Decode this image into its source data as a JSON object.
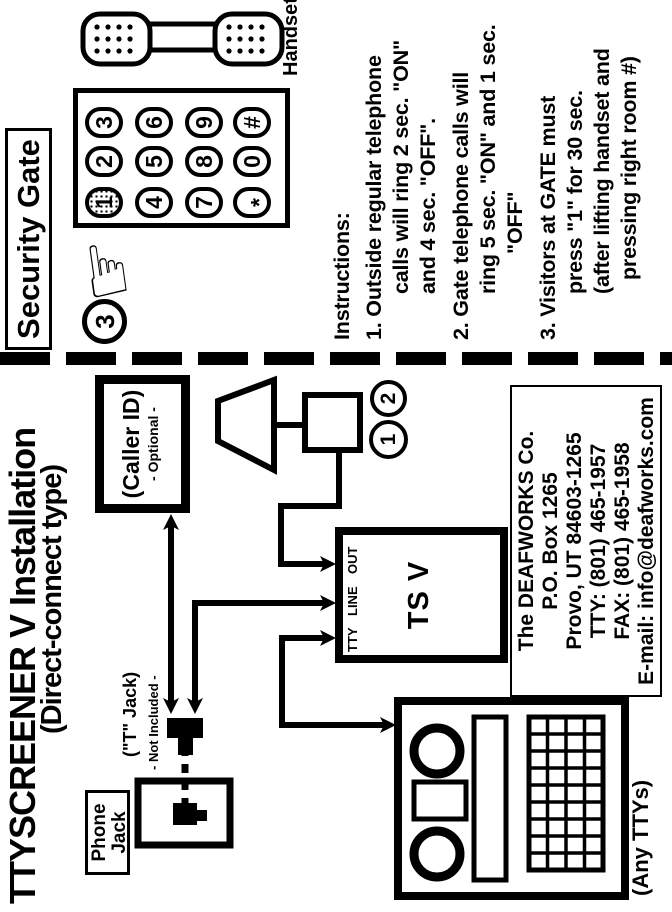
{
  "page": {
    "background": "#ffffff",
    "ink": "#000000"
  },
  "icons": {
    "pointing_hand": "☞"
  },
  "doc": {
    "title_line1": "TTYSCREENER V  Installation",
    "title_line2": "(Direct-connect type)",
    "caller_id": {
      "line1": "(Caller ID)",
      "line2": "- Optional -"
    },
    "signaler": {
      "callout_1": "1",
      "callout_2": "2"
    },
    "tsv": {
      "name": "TS V",
      "port_tty": "TTY",
      "port_line": "LINE",
      "port_out": "OUT"
    },
    "t_jack": {
      "line1": "(\"T\" Jack)",
      "line2": "- Not Included -"
    },
    "phone_jack": {
      "line1": "Phone",
      "line2": "Jack"
    },
    "any_ttys": "(Any TTYs)",
    "company": {
      "line1": "The DEAFWORKS Co.",
      "line2": "P.O. Box 1265",
      "line3": "Provo, UT  84603-1265",
      "line4": "TTY: (801) 465-1957",
      "line5": "FAX: (801) 465-1958",
      "line6": "E-mail: info@deafworks.com"
    }
  },
  "gate": {
    "title": "Security Gate",
    "callout_3": "3",
    "handset_label": "Handset",
    "keys": [
      "1",
      "2",
      "3",
      "4",
      "5",
      "6",
      "7",
      "8",
      "9",
      "*",
      "0",
      "#"
    ],
    "instructions": [
      "Instructions:",
      "1. Outside regular telephone",
      "calls will ring 2 sec. \"ON\"",
      "and 4 sec. \"OFF\".",
      "2. Gate telephone calls will",
      "ring 5 sec. \"ON\" and 1 sec.",
      "\"OFF\"",
      "3. Visitors at GATE must",
      "press \"1\" for 30 sec.",
      "(after lifting handset and",
      "pressing right room #)"
    ]
  }
}
